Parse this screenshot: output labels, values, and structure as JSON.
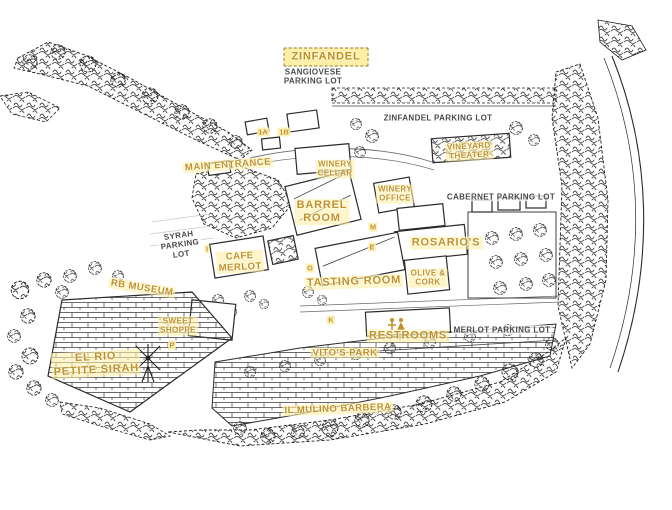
{
  "map": {
    "palette": {
      "gold": "#c0922a",
      "ink": "#222222",
      "parking_text": "#4a4a4a",
      "highlight": "rgba(253,240,166,0.6)"
    },
    "labels": [
      {
        "id": "zinfandel",
        "lines": [
          "ZINFANDEL"
        ],
        "x": 326,
        "y": 57,
        "style": "gold-lg boxed",
        "rot": 0
      },
      {
        "id": "sangiovese-parking-lot",
        "lines": [
          "SANGIOVESE",
          "PARKING LOT"
        ],
        "x": 313,
        "y": 77,
        "style": "black",
        "rot": 0
      },
      {
        "id": "zinfandel-parking-lot",
        "lines": [
          "ZINFANDEL PARKING LOT"
        ],
        "x": 438,
        "y": 118,
        "style": "black",
        "rot": 0
      },
      {
        "id": "main-entrance",
        "lines": [
          "MAIN ENTRANCE"
        ],
        "x": 228,
        "y": 165,
        "style": "gold",
        "rot": -4
      },
      {
        "id": "winery-cellar",
        "lines": [
          "WINERY",
          "CELLAR"
        ],
        "x": 335,
        "y": 169,
        "style": "gold-sm",
        "rot": 0
      },
      {
        "id": "vineyard-theater",
        "lines": [
          "VINEYARD",
          "THEATER"
        ],
        "x": 469,
        "y": 151,
        "style": "gold-sm",
        "rot": -3
      },
      {
        "id": "winery-office",
        "lines": [
          "WINERY",
          "OFFICE"
        ],
        "x": 395,
        "y": 194,
        "style": "gold-sm",
        "rot": 0
      },
      {
        "id": "barrel-room",
        "lines": [
          "BARREL",
          "ROOM"
        ],
        "x": 322,
        "y": 212,
        "style": "gold-lg",
        "rot": 0
      },
      {
        "id": "cabernet-parking-lot",
        "lines": [
          "CABERNET PARKING LOT"
        ],
        "x": 501,
        "y": 197,
        "style": "black",
        "rot": 0
      },
      {
        "id": "syrah-parking-lot",
        "lines": [
          "SYRAH",
          "PARKING",
          "LOT"
        ],
        "x": 180,
        "y": 245,
        "style": "black",
        "rot": -8
      },
      {
        "id": "rosarios",
        "lines": [
          "ROSARIO'S"
        ],
        "x": 446,
        "y": 243,
        "style": "gold-lg",
        "rot": 0
      },
      {
        "id": "cafe-merlot",
        "lines": [
          "CAFE",
          "MERLOT"
        ],
        "x": 240,
        "y": 262,
        "style": "gold",
        "rot": -3
      },
      {
        "id": "tasting-room",
        "lines": [
          "TASTING ROOM"
        ],
        "x": 354,
        "y": 282,
        "style": "gold-lg",
        "rot": -2
      },
      {
        "id": "olive-and-cork",
        "lines": [
          "OLIVE &",
          "CORK"
        ],
        "x": 428,
        "y": 278,
        "style": "gold-sm",
        "rot": 0
      },
      {
        "id": "rb-museum",
        "lines": [
          "RB MUSEUM"
        ],
        "x": 142,
        "y": 288,
        "style": "gold",
        "rot": 9
      },
      {
        "id": "sweet-shoppe",
        "lines": [
          "SWEET",
          "SHOPPE"
        ],
        "x": 178,
        "y": 326,
        "style": "gold-sm",
        "rot": 0
      },
      {
        "id": "merlot-parking-lot",
        "lines": [
          "MERLOT PARKING LOT"
        ],
        "x": 502,
        "y": 330,
        "style": "black",
        "rot": 0
      },
      {
        "id": "restrooms",
        "lines": [
          "RESTROOMS"
        ],
        "x": 408,
        "y": 336,
        "style": "gold-lg",
        "rot": 0
      },
      {
        "id": "vitos-park",
        "lines": [
          "VITO'S PARK"
        ],
        "x": 345,
        "y": 353,
        "style": "gold",
        "rot": 0
      },
      {
        "id": "el-rio-petite-sirah",
        "lines": [
          "EL RIO",
          "PETITE SIRAH"
        ],
        "x": 96,
        "y": 364,
        "style": "gold-lg",
        "rot": -3
      },
      {
        "id": "il-mulino-barbera",
        "lines": [
          "IL MULINO BARBERA"
        ],
        "x": 338,
        "y": 409,
        "style": "gold",
        "rot": -2
      }
    ],
    "markers": [
      {
        "letter": "1A",
        "x": 263,
        "y": 132
      },
      {
        "letter": "1B",
        "x": 284,
        "y": 132
      },
      {
        "letter": "M",
        "x": 373,
        "y": 227
      },
      {
        "letter": "E",
        "x": 372,
        "y": 247
      },
      {
        "letter": "I",
        "x": 207,
        "y": 249
      },
      {
        "letter": "G",
        "x": 310,
        "y": 268
      },
      {
        "letter": "K",
        "x": 331,
        "y": 320
      },
      {
        "letter": "P",
        "x": 172,
        "y": 345
      }
    ]
  }
}
